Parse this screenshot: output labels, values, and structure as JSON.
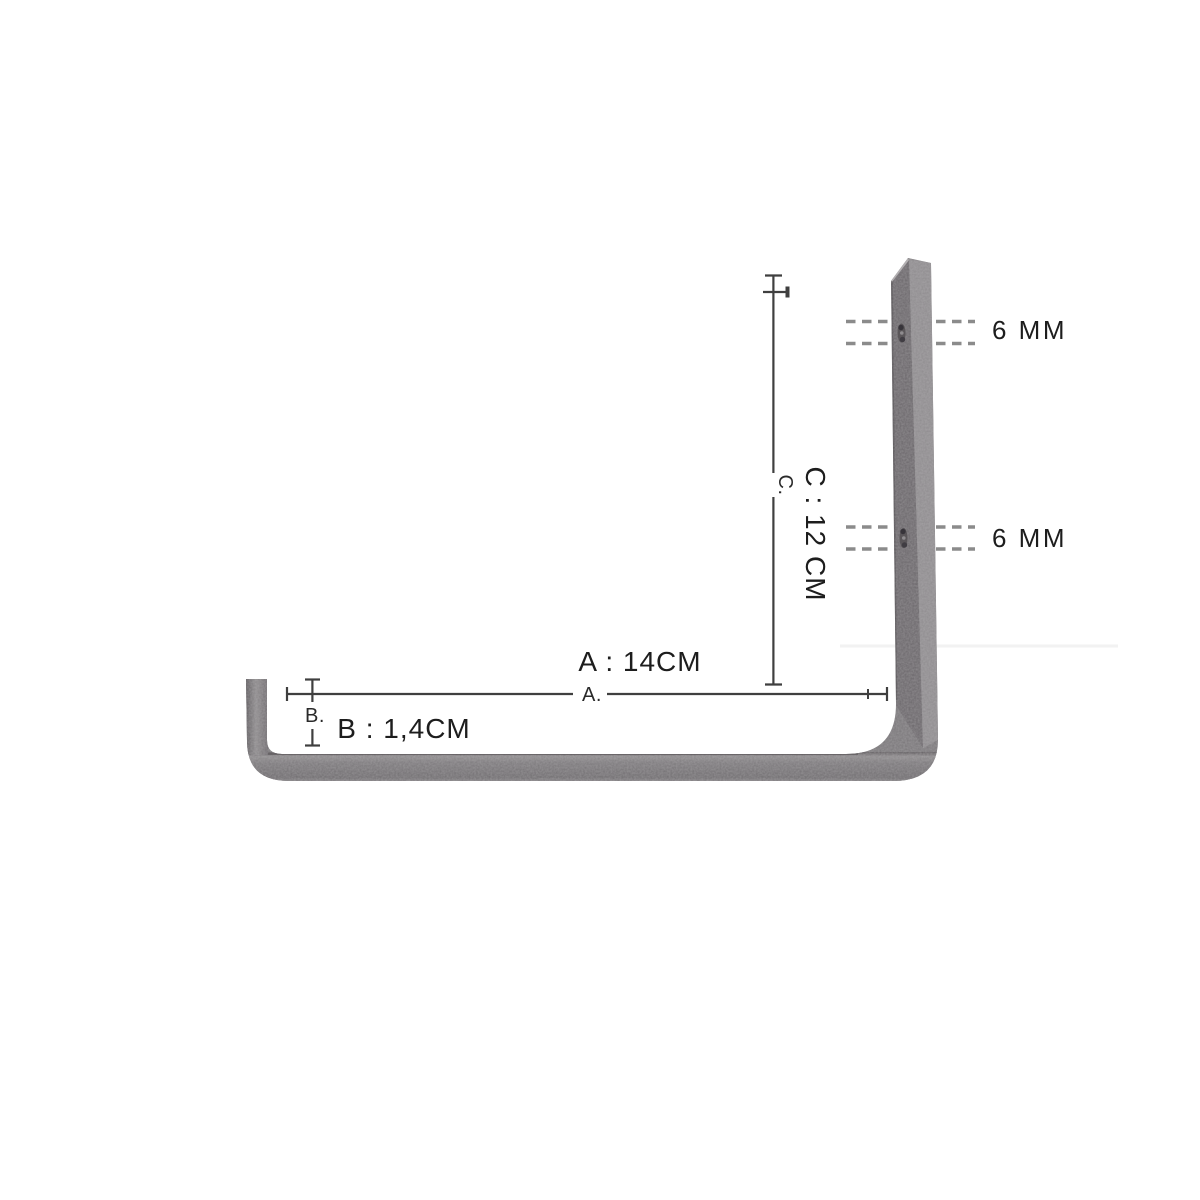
{
  "figure": {
    "kind": "product-dimension-diagram",
    "subject": "L-shaped metal wall bracket, side view"
  },
  "dimensions": {
    "a": {
      "title": "A : 14CM",
      "tick_label": "A."
    },
    "b": {
      "title": "B : 1,4CM",
      "tick_label": "B."
    },
    "c": {
      "title": "C : 12 CM",
      "tick_label": "C."
    }
  },
  "holes": {
    "top": {
      "label": "6 MM"
    },
    "bottom": {
      "label": "6 MM"
    }
  },
  "colors": {
    "background": "#ffffff",
    "metal_base": "#7a777a",
    "metal_front_face": "#6b676b",
    "metal_side_face": "#8f8c8f",
    "metal_top_highlight": "#aeaaad",
    "dimension_line": "#3f3f3f",
    "dashed_line": "#8b8b8b",
    "text": "#1d1d1d"
  }
}
